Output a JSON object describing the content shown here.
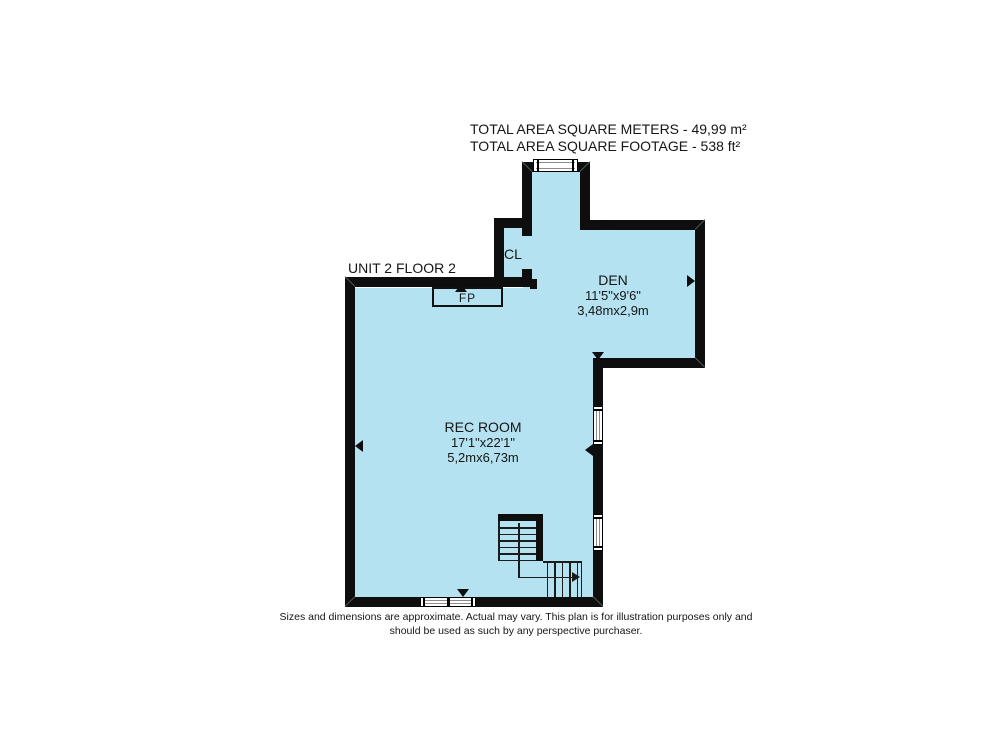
{
  "header": {
    "line1": "TOTAL AREA SQUARE METERS - 49,99 m²",
    "line2": "TOTAL AREA SQUARE FOOTAGE  - 538 ft²"
  },
  "plan": {
    "unit_label": "UNIT 2 FLOOR 2",
    "colors": {
      "floor_fill": "#b4e2f1",
      "wall": "#0e0e0e",
      "window_frame": "#8b8b8b"
    },
    "rooms": {
      "den": {
        "name": "DEN",
        "imperial": "11'5\"x9'6\"",
        "metric": "3,48mx2,9m"
      },
      "rec_room": {
        "name": "REC ROOM",
        "imperial": "17'1\"x22'1\"",
        "metric": "5,2mx6,73m"
      },
      "closet": {
        "label": "CL"
      },
      "fireplace": {
        "label": "FP"
      }
    }
  },
  "footer": {
    "line1": "Sizes and dimensions are approximate. Actual may vary. This plan is for illustration purposes only and",
    "line2": "should be used as such by any perspective purchaser."
  }
}
